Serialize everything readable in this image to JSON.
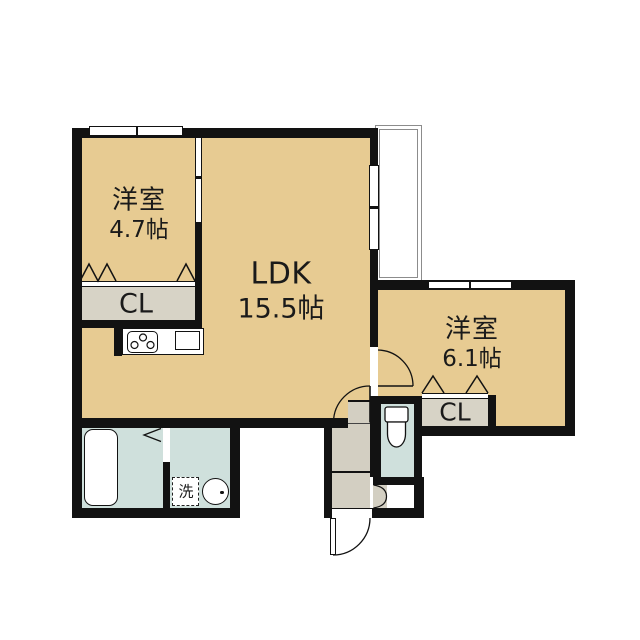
{
  "floorplan": {
    "background": "#ffffff",
    "palette": {
      "room_floor": "#e7cb92",
      "closet_floor": "#d7d3c6",
      "hall_floor": "#d3cfc2",
      "wet_area_floor": "#cfe0dc",
      "wall": "#121212",
      "balcony_outline": "#8c8c8c",
      "label_text": "#1a1a1a"
    },
    "rooms": {
      "bedroom1": {
        "name": "洋室",
        "size": "4.7帖"
      },
      "ldk": {
        "name": "LDK",
        "size": "15.5帖"
      },
      "bedroom2": {
        "name": "洋室",
        "size": "6.1帖"
      },
      "closet1": {
        "label": "CL"
      },
      "closet2": {
        "label": "CL"
      },
      "laundry": {
        "label": "洗"
      }
    },
    "fixtures": [
      "bathtub",
      "toilet",
      "wash-basin",
      "washing-machine-space",
      "kitchen-stove",
      "kitchen-sink",
      "balcony",
      "entry-door",
      "swing-doors",
      "sliding-door",
      "closet-folding-doors",
      "windows"
    ]
  }
}
